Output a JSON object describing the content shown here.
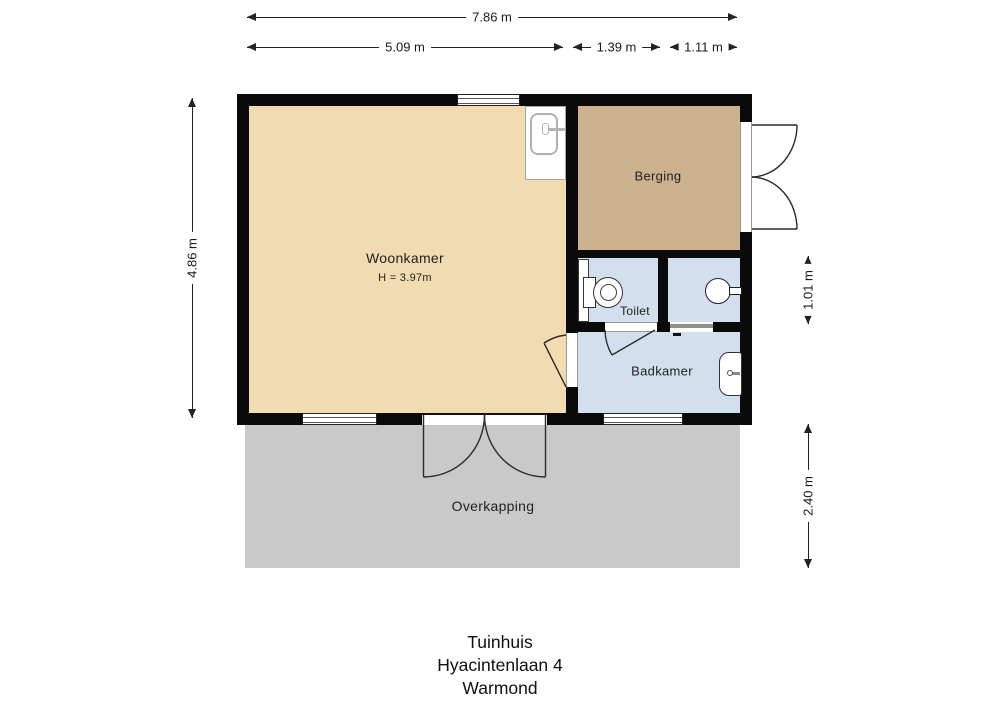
{
  "plan": {
    "title_lines": [
      "Tuinhuis",
      "Hyacintenlaan 4",
      "Warmond"
    ],
    "dimensions": {
      "total_width": "7.86 m",
      "woonkamer_width": "5.09 m",
      "berging_depth": "1.39 m",
      "sinkroom_width": "1.11 m",
      "building_height": "4.86 m",
      "toilet_row_height": "1.01 m",
      "overkapping_depth": "2.40 m"
    },
    "rooms": {
      "woonkamer": {
        "label": "Woonkamer",
        "height_note": "H = 3.97m",
        "color": "#F1DBB1"
      },
      "berging": {
        "label": "Berging",
        "color": "#CCB18E"
      },
      "toilet": {
        "label": "Toilet",
        "color": "#D2DFED"
      },
      "sinkroom": {
        "color": "#D2DFED"
      },
      "badkamer": {
        "label": "Badkamer",
        "color": "#D2DFED"
      },
      "overkapping": {
        "label": "Overkapping",
        "color": "#C9C9C9"
      }
    },
    "colors": {
      "wall": "#0a0a0a",
      "dimension_line": "#222222",
      "fixture_outline": "#333333"
    },
    "fixtures": [
      "kitchen-sink",
      "toilet",
      "washbasin",
      "bathroom-basin"
    ]
  }
}
